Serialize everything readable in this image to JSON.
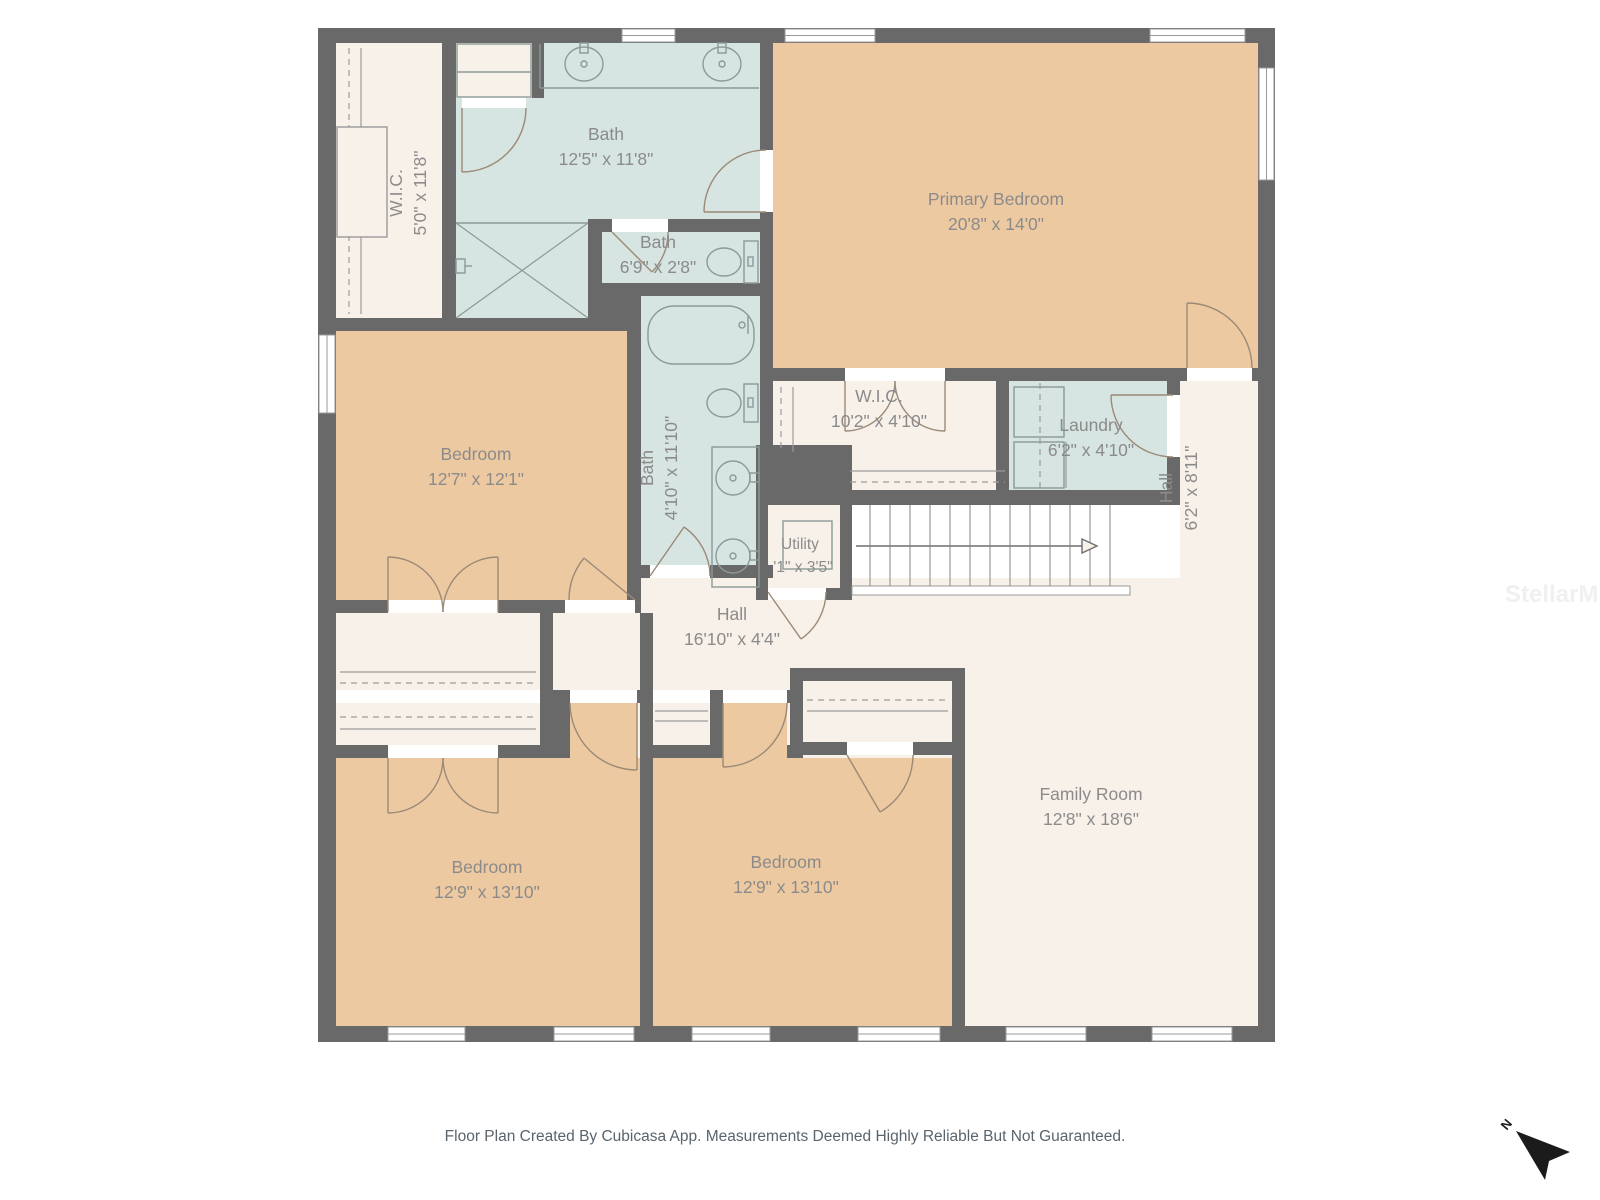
{
  "plan": {
    "rooms": {
      "wic_top": {
        "name": "W.I.C.",
        "dims": "5'0\" x 11'8\""
      },
      "bath_top": {
        "name": "Bath",
        "dims": "12'5\" x 11'8\""
      },
      "bath_small": {
        "name": "Bath",
        "dims": "6'9\" x 2'8\""
      },
      "primary_bedroom": {
        "name": "Primary Bedroom",
        "dims": "20'8\" x 14'0\""
      },
      "bedroom_mid": {
        "name": "Bedroom",
        "dims": "12'7\" x 12'1\""
      },
      "bath_mid": {
        "name": "Bath",
        "dims": "4'10\" x 11'10\""
      },
      "wic_mid": {
        "name": "W.I.C.",
        "dims": "10'2\" x 4'10\""
      },
      "laundry": {
        "name": "Laundry",
        "dims": "6'2\" x 4'10\""
      },
      "hall_right": {
        "name": "Hall",
        "dims": "6'2\" x 8'11\""
      },
      "utility": {
        "name": "Utility",
        "dims": "'1\" x 3'5\""
      },
      "hall_center": {
        "name": "Hall",
        "dims": "16'10\" x 4'4\""
      },
      "family_room": {
        "name": "Family Room",
        "dims": "12'8\" x 18'6\""
      },
      "bedroom_bl": {
        "name": "Bedroom",
        "dims": "12'9\" x 13'10\""
      },
      "bedroom_bm": {
        "name": "Bedroom",
        "dims": "12'9\" x 13'10\""
      }
    },
    "compass_label": "N",
    "watermark": "StellarMLS",
    "footer": "Floor Plan Created By Cubicasa App. Measurements Deemed Highly Reliable But Not Guaranteed.",
    "colors": {
      "wall": "#696969",
      "bedroom_fill": "#edc9a1",
      "bath_fill": "#d6e4e2",
      "hall_fill": "#f8f1ea",
      "label_text": "#8b8b8b",
      "door_arc": "#9b8a77",
      "fixture": "#8b9a98"
    }
  }
}
